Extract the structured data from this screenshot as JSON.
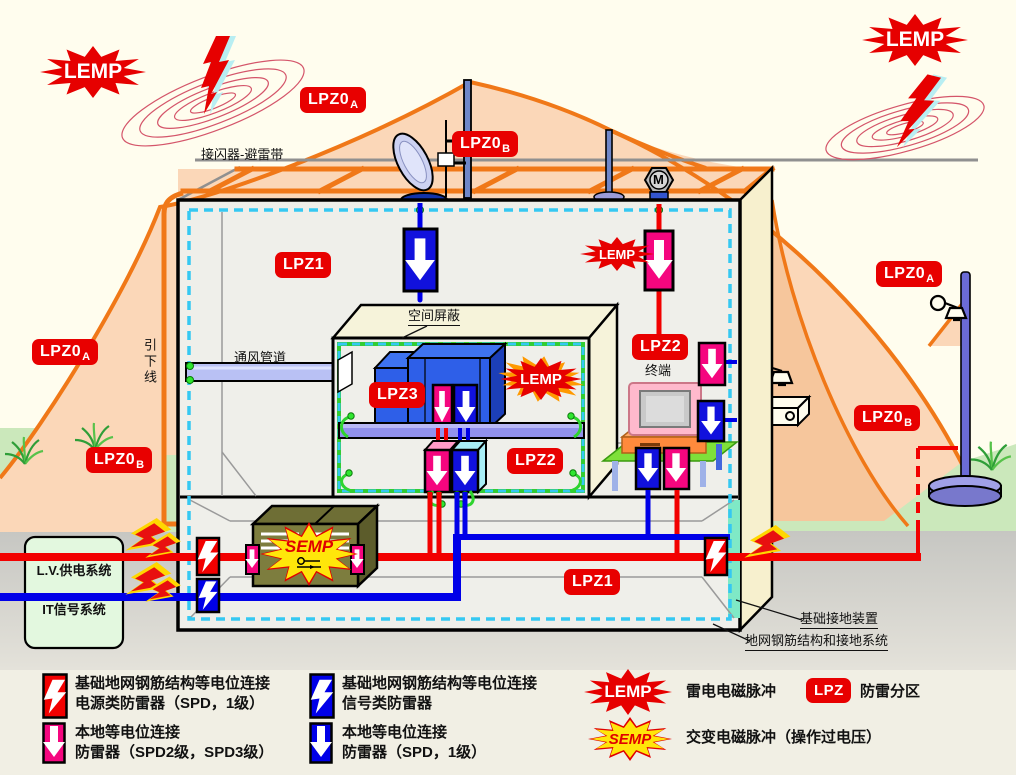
{
  "title": "防雷分区（LPZ）与电磁脉冲防护示意图",
  "zones": {
    "lpz0": "LPZ0",
    "sub_a": "A",
    "sub_b": "B",
    "lpz1": "LPZ1",
    "lpz2": "LPZ2",
    "lpz3": "LPZ3",
    "lpz": "LPZ"
  },
  "bursts": {
    "lemp": "LEMP",
    "semp": "SEMP"
  },
  "annotations": {
    "air_terminal": "接闪器-避雷带",
    "down_conductor": "引下线",
    "vent_duct": "通风管道",
    "space_shield": "空间屏蔽",
    "terminal": "终端",
    "lv_power": "L.V.供电系统",
    "it_signal": "IT信号系统",
    "foundation_ground": "基础接地装置",
    "ground_grid": "地网钢筋结构和接地系统",
    "motor": "M"
  },
  "legend": {
    "spd_items": [
      {
        "icon": "red-bolt-box",
        "line1": "基础地网钢筋结构等电位连接",
        "line2": "电源类防雷器（SPD，1级）"
      },
      {
        "icon": "blue-bolt-box",
        "line1": "基础地网钢筋结构等电位连接",
        "line2": "信号类防雷器"
      },
      {
        "icon": "pink-arrow-box",
        "line1": "本地等电位连接",
        "line2": "防雷器（SPD2级，SPD3级）"
      },
      {
        "icon": "blue-arrow-box",
        "line1": "本地等电位连接",
        "line2": "防雷器（SPD，1级）"
      }
    ],
    "lemp_label": "雷电电磁脉冲",
    "semp_label": "交变电磁脉冲（操作过电压）",
    "lpz_label": "防雷分区"
  },
  "colors": {
    "zone_badge_red": "#E80000",
    "spd_pink": "#F5067F",
    "spd_blue": "#1111DD",
    "spd_red": "#F20000",
    "wire_red": "#F20000",
    "wire_blue": "#0000E8",
    "bond_green": "#2FD42F",
    "shield_cyan": "#35C8F2",
    "protection_orange": "#F07818",
    "zone_peach": "#FBD7B8",
    "semp_yellow": "#FFE60A",
    "equipment_olive": "#7D7D3E"
  }
}
